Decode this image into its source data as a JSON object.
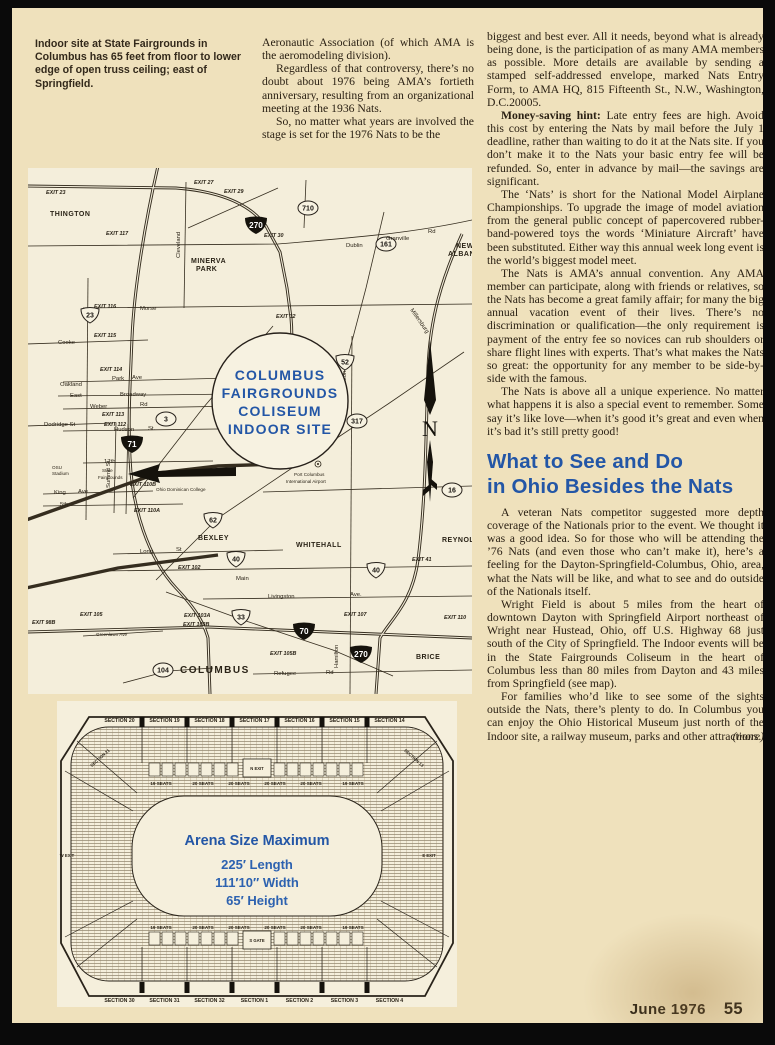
{
  "caption": "Indoor site at State Fairgrounds in Columbus has 65 feet from floor to lower edge of open truss ceiling; east of Springfield.",
  "intro_column": {
    "paragraphs": [
      {
        "indent": false,
        "text": "Aeronautic Association (of which AMA is the aeromodeling division)."
      },
      {
        "indent": true,
        "text": "Regardless of that controversy, there’s no doubt about 1976 being AMA’s fortieth anniversary, resulting from an organizational meeting at the 1936 Nats."
      },
      {
        "indent": true,
        "text": "So, no matter what years are involved the stage is set for the 1976 Nats to be the"
      }
    ]
  },
  "right_column": {
    "paragraphs_top": [
      {
        "indent": false,
        "lead": "",
        "text": "biggest and best ever. All it needs, beyond what is already being done, is the participation of as many AMA members as possible. More details are available by sending a stamped self-addressed envelope, marked Nats Entry Form, to AMA HQ, 815 Fifteenth St., N.W., Washington, D.C.20005."
      },
      {
        "indent": true,
        "lead": "Money-saving hint:",
        "text": " Late entry fees are high. Avoid this cost by entering the Nats by mail before the July 1 deadline, rather than waiting to do it at the Nats site. If you don’t make it to the Nats your basic entry fee will be refunded. So, enter in advance by mail—the savings are significant."
      },
      {
        "indent": true,
        "lead": "",
        "text": "The ‘Nats’ is short for the National Model Airplane Championships. To upgrade the image of model aviation from the general public concept of papercovered rubber-band-powered toys the words ‘Miniature Aircraft’ have been substituted. Either way this annual week long event is the world’s biggest model meet."
      },
      {
        "indent": true,
        "lead": "",
        "text": "The Nats is AMA’s annual convention. Any AMA member can participate, along with friends or relatives, so the Nats has become a great family affair; for many the big annual vacation event of their lives. There’s no discrimination or qualification—the only requirement is payment of the entry fee so novices can rub shoulders or share flight lines with experts. That’s what makes the Nats so great: the opportunity for any member to be side-by-side with the famous."
      },
      {
        "indent": true,
        "lead": "",
        "text": "The Nats is above all a unique experience. No matter what happens it is also a special event to remember. Some say it’s like love—when it’s good it’s great and even when it’s bad it’s still pretty good!"
      }
    ],
    "heading": {
      "line1": "What to See and Do",
      "line2": "in Ohio  Besides the Nats"
    },
    "paragraphs_bottom": [
      {
        "indent": true,
        "lead": "",
        "text": "A veteran Nats competitor suggested more depth coverage of the Nationals prior to the event. We thought it was a good idea. So for those who will be attending the ’76 Nats (and even those who can’t make it), here’s a feeling for the Dayton-Springfield-Columbus, Ohio, area, what the Nats will be like, and what to see and do outside of the Nationals itself."
      },
      {
        "indent": true,
        "lead": "",
        "text": "Wright Field is about 5 miles from the heart of downtown Dayton with Springfield Airport northeast of Wright near Hustead, Ohio, off U.S. Highway 68 just south of the City of Springfield. The Indoor events will be in the State Fairgrounds Coliseum in the heart of Columbus less than 80 miles from Dayton and 43 miles from Springfield (see map)."
      },
      {
        "indent": true,
        "lead": "",
        "text": "For families who’d like to see some of the sights outside the Nats, there’s plenty to do. In Columbus you can enjoy the Ohio Historical Museum just north of the Indoor site, a railway museum, parks and other attractions."
      }
    ],
    "more_label": "(more)"
  },
  "footer": {
    "issue": "June 1976",
    "page_number": "55"
  },
  "map": {
    "site_circle": {
      "lines": [
        "COLUMBUS",
        "FAIRGROUNDS",
        "COLISEUM",
        "INDOOR SITE"
      ]
    },
    "north_label": "N",
    "airport": {
      "line1": "Port Columbus",
      "line2": "International Airport"
    },
    "fairgrounds": {
      "line1": "State",
      "line2": "Fairgrounds"
    },
    "shields": [
      {
        "type": "i",
        "n": "270",
        "x": 228,
        "y": 57
      },
      {
        "type": "i",
        "n": "71",
        "x": 104,
        "y": 276
      },
      {
        "type": "i",
        "n": "70",
        "x": 276,
        "y": 463
      },
      {
        "type": "i",
        "n": "270",
        "x": 333,
        "y": 486
      },
      {
        "type": "u",
        "n": "23",
        "x": 62,
        "y": 147
      },
      {
        "type": "u",
        "n": "52",
        "x": 317,
        "y": 194
      },
      {
        "type": "u",
        "n": "62",
        "x": 185,
        "y": 352
      },
      {
        "type": "u",
        "n": "40",
        "x": 208,
        "y": 391
      },
      {
        "type": "u",
        "n": "40",
        "x": 348,
        "y": 402
      },
      {
        "type": "u",
        "n": "33",
        "x": 213,
        "y": 449
      },
      {
        "type": "s",
        "n": "710",
        "x": 280,
        "y": 40
      },
      {
        "type": "s",
        "n": "161",
        "x": 358,
        "y": 76
      },
      {
        "type": "s",
        "n": "3",
        "x": 138,
        "y": 251
      },
      {
        "type": "s",
        "n": "317",
        "x": 329,
        "y": 253
      },
      {
        "type": "s",
        "n": "16",
        "x": 424,
        "y": 322
      },
      {
        "type": "s",
        "n": "104",
        "x": 135,
        "y": 502
      }
    ],
    "labels": [
      {
        "t": "THINGTON",
        "x": 22,
        "y": 48,
        "c": "ml-town"
      },
      {
        "t": "MINERVA",
        "x": 163,
        "y": 95,
        "c": "ml-town"
      },
      {
        "t": "PARK",
        "x": 168,
        "y": 103,
        "c": "ml-town"
      },
      {
        "t": "NEW",
        "x": 428,
        "y": 80,
        "c": "ml-town"
      },
      {
        "t": "ALBANY",
        "x": 420,
        "y": 88,
        "c": "ml-town"
      },
      {
        "t": "BEXLEY",
        "x": 170,
        "y": 372,
        "c": "ml-town"
      },
      {
        "t": "WHITEHALL",
        "x": 268,
        "y": 379,
        "c": "ml-town"
      },
      {
        "t": "REYNOLDS",
        "x": 414,
        "y": 374,
        "c": "ml-town"
      },
      {
        "t": "BRICE",
        "x": 388,
        "y": 491,
        "c": "ml-town"
      },
      {
        "t": "COLUMBUS",
        "x": 152,
        "y": 505,
        "c": "ml-big"
      },
      {
        "t": "OSU",
        "x": 24,
        "y": 301,
        "c": "ml-tiny"
      },
      {
        "t": "Stadium",
        "x": 24,
        "y": 307,
        "c": "ml-tiny"
      },
      {
        "t": "Dublin",
        "x": 318,
        "y": 79,
        "c": "ml-road"
      },
      {
        "t": "Granville",
        "x": 358,
        "y": 72,
        "c": "ml-road"
      },
      {
        "t": "Rd",
        "x": 400,
        "y": 65,
        "c": "ml-road"
      },
      {
        "t": "Morse",
        "x": 112,
        "y": 142,
        "c": "ml-road"
      },
      {
        "t": "Cooke",
        "x": 30,
        "y": 176,
        "c": "ml-road"
      },
      {
        "t": "Oakland",
        "x": 32,
        "y": 218,
        "c": "ml-road"
      },
      {
        "t": "Park",
        "x": 84,
        "y": 212,
        "c": "ml-road"
      },
      {
        "t": "Ave",
        "x": 104,
        "y": 211,
        "c": "ml-road"
      },
      {
        "t": "East",
        "x": 42,
        "y": 229,
        "c": "ml-road"
      },
      {
        "t": "Broadway",
        "x": 92,
        "y": 228,
        "c": "ml-road"
      },
      {
        "t": "Weber",
        "x": 62,
        "y": 240,
        "c": "ml-road"
      },
      {
        "t": "Rd",
        "x": 112,
        "y": 238,
        "c": "ml-road"
      },
      {
        "t": "Hudson",
        "x": 86,
        "y": 263,
        "c": "ml-road"
      },
      {
        "t": "St.",
        "x": 120,
        "y": 262,
        "c": "ml-road"
      },
      {
        "t": "Dodridge St",
        "x": 16,
        "y": 258,
        "c": "ml-road"
      },
      {
        "t": "17th",
        "x": 76,
        "y": 295,
        "c": "ml-road"
      },
      {
        "t": "King",
        "x": 26,
        "y": 326,
        "c": "ml-road"
      },
      {
        "t": "Ave",
        "x": 50,
        "y": 325,
        "c": "ml-road"
      },
      {
        "t": "5th",
        "x": 32,
        "y": 338,
        "c": "ml-road"
      },
      {
        "t": "Long",
        "x": 112,
        "y": 385,
        "c": "ml-road"
      },
      {
        "t": "St",
        "x": 148,
        "y": 383,
        "c": "ml-road"
      },
      {
        "t": "Main",
        "x": 208,
        "y": 412,
        "c": "ml-road"
      },
      {
        "t": "Livingston",
        "x": 240,
        "y": 430,
        "c": "ml-road"
      },
      {
        "t": "Ave.",
        "x": 322,
        "y": 428,
        "c": "ml-road"
      },
      {
        "t": "Refugee",
        "x": 246,
        "y": 507,
        "c": "ml-road"
      },
      {
        "t": "Rd",
        "x": 298,
        "y": 506,
        "c": "ml-road"
      },
      {
        "t": "Greenlawn Ave",
        "x": 68,
        "y": 468,
        "c": "ml-tiny"
      },
      {
        "t": "Ohio Dominican College",
        "x": 128,
        "y": 323,
        "c": "ml-tiny"
      },
      {
        "t": "Hamilton",
        "x": 318,
        "y": 226,
        "c": "ml-road",
        "rot": -90
      },
      {
        "t": "Hamilton",
        "x": 310,
        "y": 500,
        "c": "ml-road",
        "rot": -90
      },
      {
        "t": "Cleveland",
        "x": 152,
        "y": 90,
        "c": "ml-road",
        "rot": -90
      },
      {
        "t": "Summit St",
        "x": 82,
        "y": 320,
        "c": "ml-road",
        "rot": -90
      },
      {
        "t": "Millersburg",
        "x": 382,
        "y": 142,
        "c": "ml-road",
        "rot": 55
      },
      {
        "t": "EXIT 23",
        "x": 18,
        "y": 26,
        "c": "ml-ex"
      },
      {
        "t": "EXIT 27",
        "x": 166,
        "y": 16,
        "c": "ml-ex"
      },
      {
        "t": "EXIT 29",
        "x": 196,
        "y": 25,
        "c": "ml-ex"
      },
      {
        "t": "EXIT 30",
        "x": 236,
        "y": 69,
        "c": "ml-ex"
      },
      {
        "t": "EXIT 32",
        "x": 248,
        "y": 150,
        "c": "ml-ex"
      },
      {
        "t": "EXIT 117",
        "x": 78,
        "y": 67,
        "c": "ml-ex"
      },
      {
        "t": "EXIT 116",
        "x": 66,
        "y": 140,
        "c": "ml-ex"
      },
      {
        "t": "EXIT 115",
        "x": 66,
        "y": 169,
        "c": "ml-ex"
      },
      {
        "t": "EXIT 114",
        "x": 72,
        "y": 203,
        "c": "ml-ex"
      },
      {
        "t": "EXIT 113",
        "x": 74,
        "y": 248,
        "c": "ml-ex"
      },
      {
        "t": "EXIT 112",
        "x": 76,
        "y": 258,
        "c": "ml-ex"
      },
      {
        "t": "EXIT 110B",
        "x": 102,
        "y": 318,
        "c": "ml-ex"
      },
      {
        "t": "EXIT 110A",
        "x": 106,
        "y": 344,
        "c": "ml-ex"
      },
      {
        "t": "EXIT 102",
        "x": 150,
        "y": 401,
        "c": "ml-ex"
      },
      {
        "t": "EXIT 105",
        "x": 52,
        "y": 448,
        "c": "ml-ex"
      },
      {
        "t": "EXIT 98B",
        "x": 4,
        "y": 456,
        "c": "ml-ex"
      },
      {
        "t": "EXIT 103A",
        "x": 156,
        "y": 449,
        "c": "ml-ex"
      },
      {
        "t": "EXIT 103B",
        "x": 155,
        "y": 458,
        "c": "ml-ex"
      },
      {
        "t": "EXIT 105B",
        "x": 242,
        "y": 487,
        "c": "ml-ex"
      },
      {
        "t": "EXIT 107",
        "x": 316,
        "y": 448,
        "c": "ml-ex"
      },
      {
        "t": "EXIT 110",
        "x": 416,
        "y": 451,
        "c": "ml-ex"
      },
      {
        "t": "EXIT 41",
        "x": 384,
        "y": 393,
        "c": "ml-ex"
      }
    ]
  },
  "arena": {
    "title": "Arena Size Maximum",
    "dimensions": [
      "225′ Length",
      "111′10″ Width",
      "65′ Height"
    ],
    "top_sections": [
      "SECTION 20",
      "SECTION 19",
      "SECTION 18",
      "SECTION 17",
      "SECTION 16",
      "SECTION 15",
      "SECTION 14"
    ],
    "bottom_sections": [
      "SECTION 30",
      "SECTION 31",
      "SECTION 32",
      "SECTION 1",
      "SECTION 2",
      "SECTION 3",
      "SECTION 4"
    ],
    "top_seats": [
      "19 SEATS",
      "20 SEATS",
      "20 SEATS",
      "20 SEATS",
      "20 SEATS",
      "19 SEATS"
    ],
    "bottom_seats": [
      "19 SEATS",
      "20 SEATS",
      "20 SEATS",
      "20 SEATS",
      "20 SEATS",
      "19 SEATS"
    ],
    "gate_top": "N EXIT",
    "gate_bottom": "S GATE",
    "corner_left": "SECTION 21",
    "corner_right": "SECTION 13",
    "exit_left": "W EXIT",
    "exit_right": "E EXIT"
  }
}
